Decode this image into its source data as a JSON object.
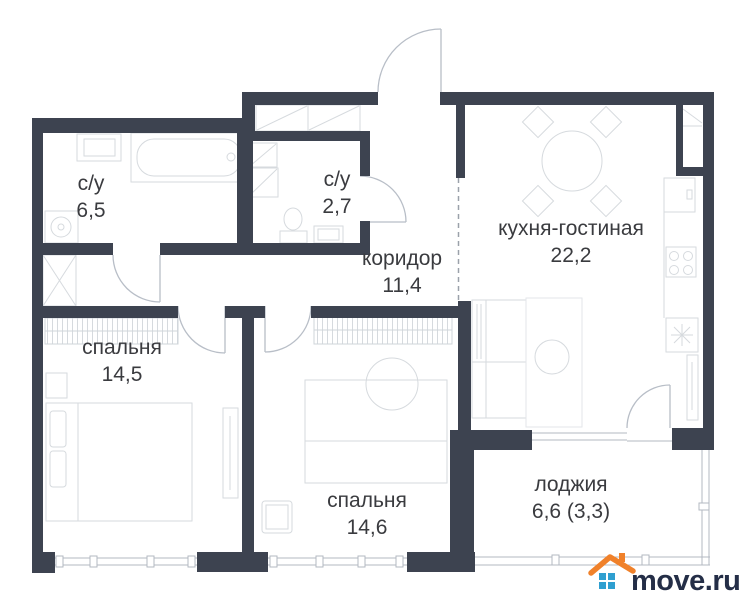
{
  "plan": {
    "rooms": [
      {
        "name": "с/у",
        "area": "6,5"
      },
      {
        "name": "с/у",
        "area": "2,7"
      },
      {
        "name": "коридор",
        "area": "11,4"
      },
      {
        "name": "кухня-гостиная",
        "area": "22,2"
      },
      {
        "name": "спальня",
        "area": "14,5"
      },
      {
        "name": "спальня",
        "area": "14,6"
      },
      {
        "name": "лоджия",
        "area": "6,6 (3,3)"
      }
    ]
  },
  "branding": {
    "logo_text": "move.ru"
  },
  "colors": {
    "wall": "#3d4350",
    "furniture_line": "#d6dade",
    "door_line": "#b8bec7",
    "window_line": "#b3b9c2",
    "dashed_line": "#9ba1aa",
    "label_text": "#3a3b3f",
    "logo_text": "#242e47",
    "logo_roof": "#f0812a",
    "logo_window": "#2f9fd0"
  }
}
